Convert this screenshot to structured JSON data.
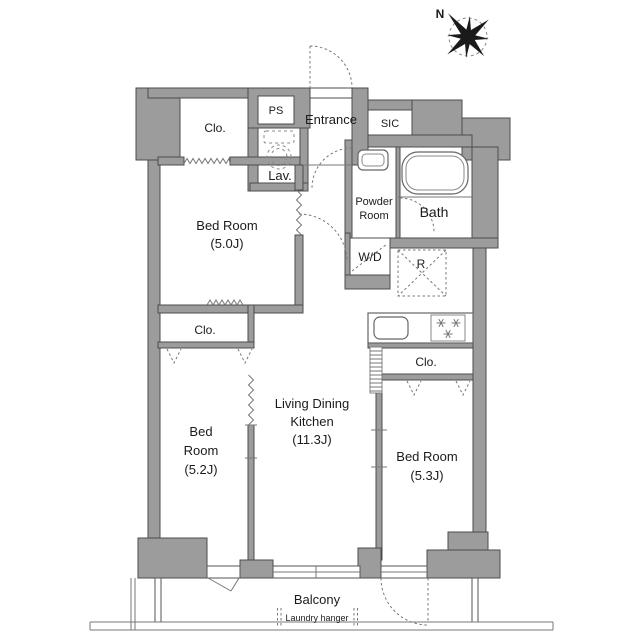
{
  "compass": {
    "north_label": "N"
  },
  "rooms": {
    "closet_top_left": "Clo.",
    "pipe_space": "PS",
    "entrance": "Entrance",
    "shoe_closet": "SIC",
    "lavatory": "Lav.",
    "powder_room": {
      "line1": "Powder",
      "line2": "Room"
    },
    "bath": "Bath",
    "washer_dryer": "W/D",
    "refrigerator": "R",
    "bedroom_1": {
      "name": "Bed Room",
      "size": "(5.0J)"
    },
    "closet_mid_left": "Clo.",
    "bedroom_2": {
      "line1": "Bed",
      "line2": "Room",
      "size": "(5.2J)"
    },
    "ldk": {
      "line1": "Living Dining",
      "line2": "Kitchen",
      "size": "(11.3J)"
    },
    "closet_right": "Clo.",
    "bedroom_3": {
      "name": "Bed Room",
      "size": "(5.3J)"
    },
    "balcony": "Balcony",
    "laundry_hanger": "Laundry hanger"
  },
  "colors": {
    "wall": "#9c9c9c",
    "wall_outline": "#4c4c4c",
    "line": "#666666",
    "text": "#1b1b1b"
  }
}
